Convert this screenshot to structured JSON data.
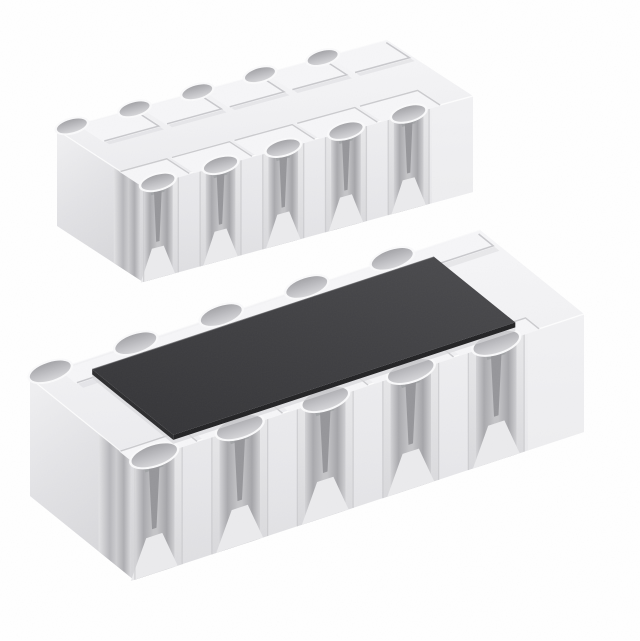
{
  "scene": {
    "type": "product-photo",
    "subject": "chip-resistor-network-array",
    "description": "3D product render of a white ceramic chip resistor network array shown from two angles on a white background: upper-left component shows the underside with castellated solder terminals and raised terminal lands; lower-right component shows the top side covered by a dark resistive element coating.",
    "background_color": "#ffffff",
    "views": [
      {
        "id": "underside-view",
        "position": "upper-left",
        "shows": "terminal lands and castellated edges"
      },
      {
        "id": "top-view",
        "position": "lower-right",
        "shows": "dark resistive coating on top face"
      }
    ],
    "terminals_per_side": 5
  },
  "colors": {
    "background": "#ffffff",
    "body-top": "#f4f4f6",
    "body-front": "#e9e9ec",
    "body-end": "#e0e0e3",
    "groove": "#aaaaae",
    "groove-slot": "#96969a",
    "flare": "#ebebed",
    "seam": "#c8c8cb",
    "pad": "#f6f6f8",
    "pad-shadow": "#c3c3c7",
    "soft-shadow": "#dddde0",
    "collar": "#fafafb",
    "notch": "#a8a8ac",
    "end-block": "#f2f2f4",
    "edge-highlight": "#ffffff",
    "coat-shadow": "#d8d8db",
    "coating-top": "#414144",
    "coating-edge": "#232325",
    "coating-edge-side": "#2d2d2f",
    "coat-highlight": "#5e5e61"
  }
}
